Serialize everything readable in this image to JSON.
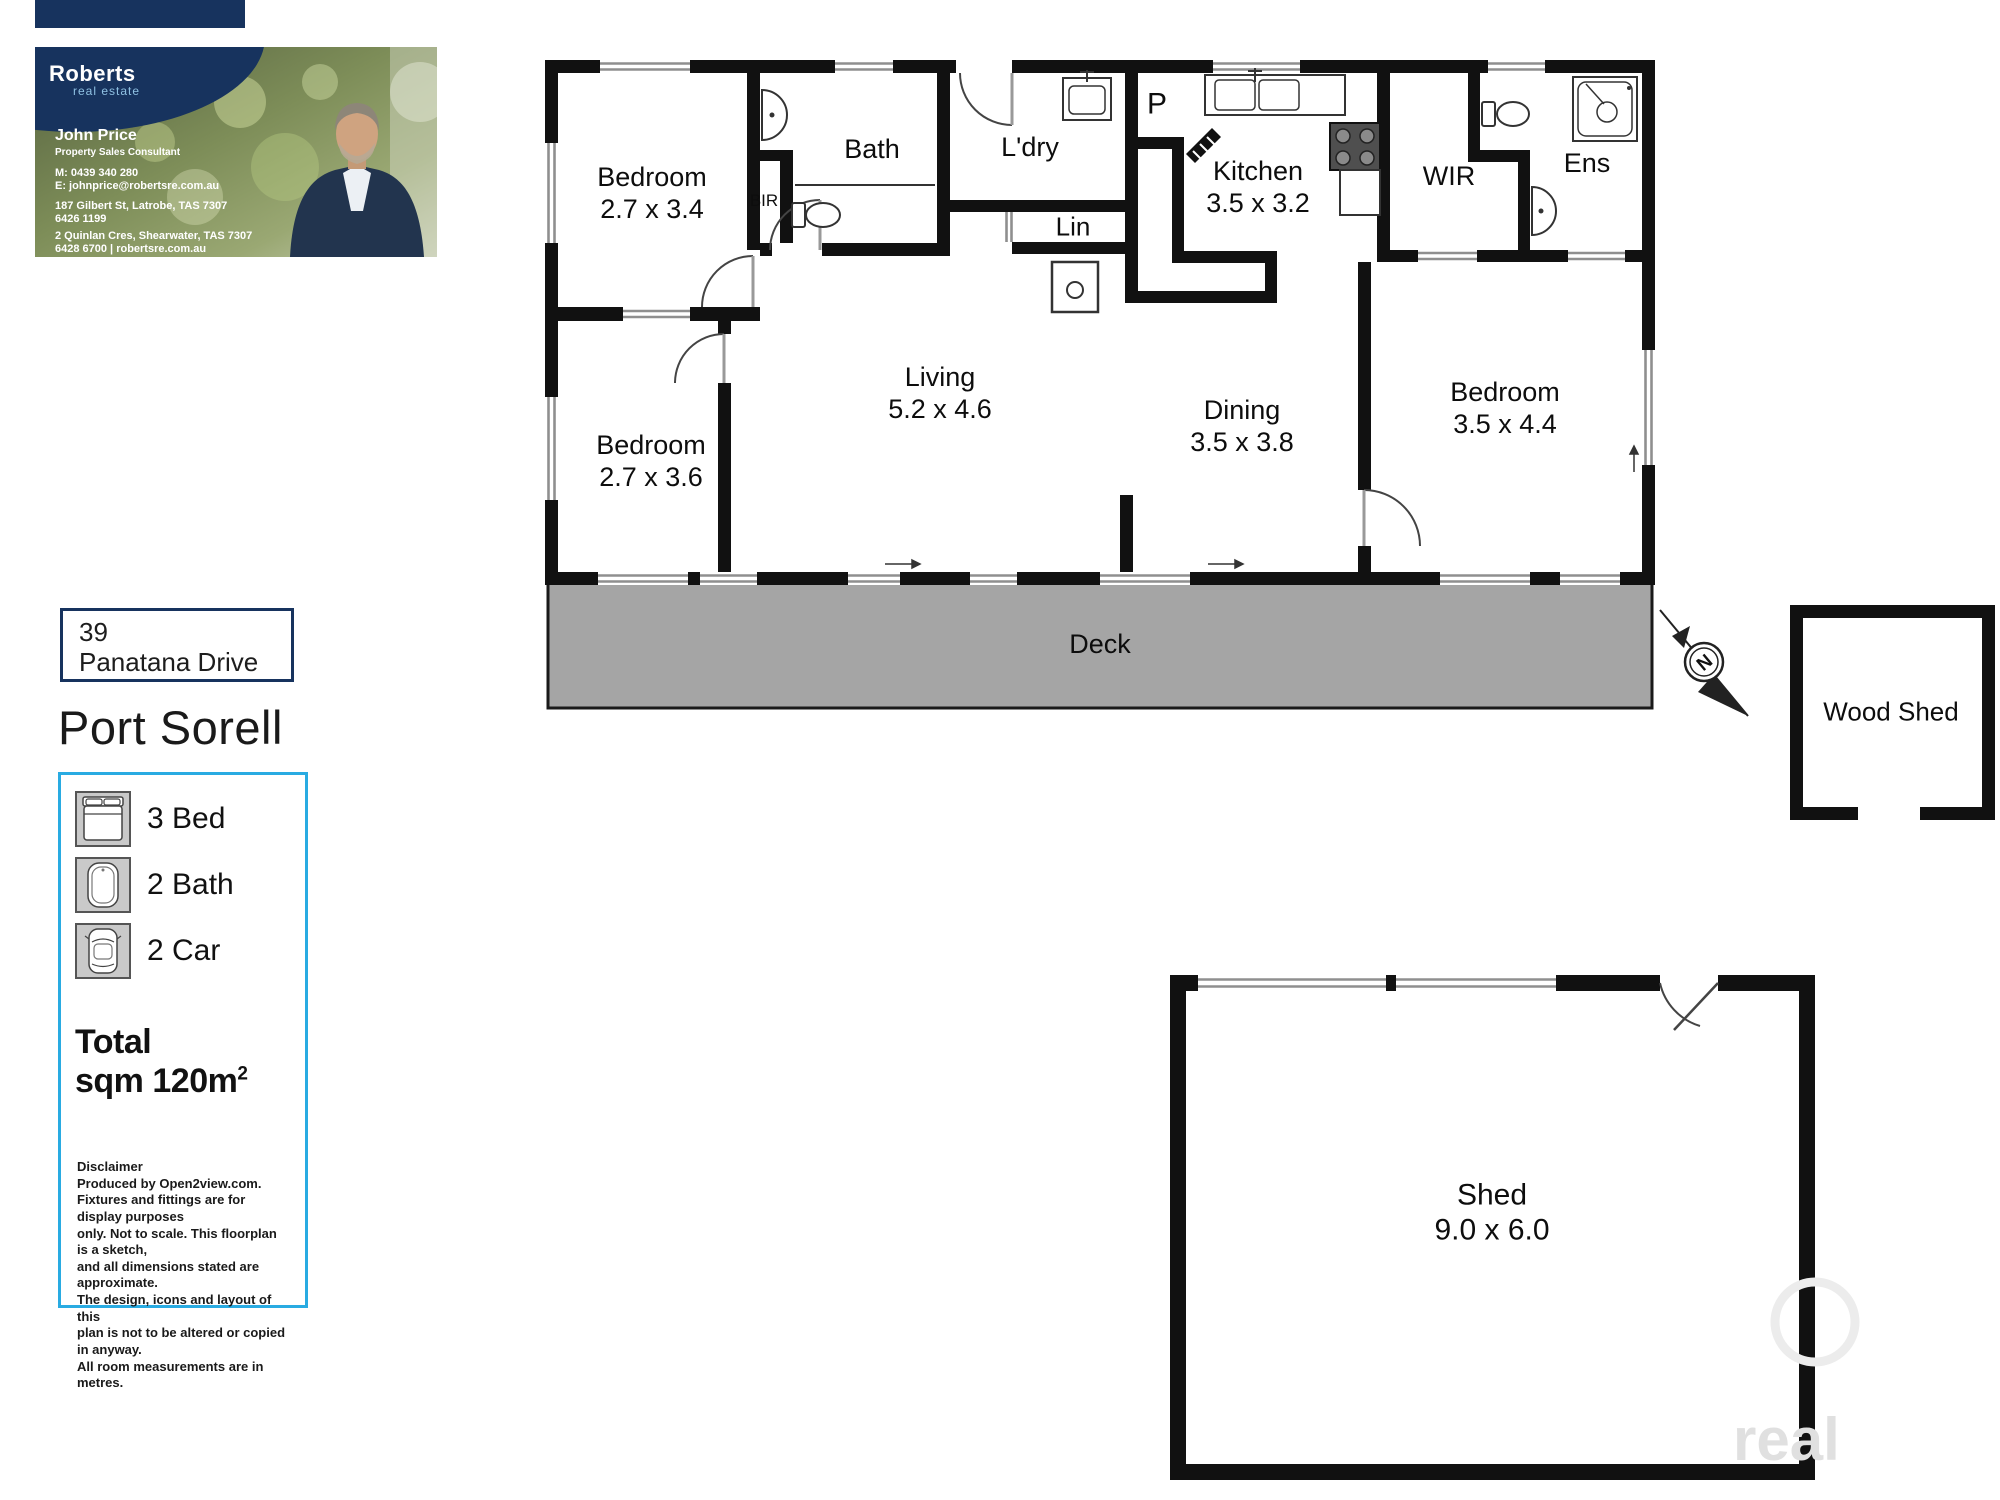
{
  "agent_card": {
    "brand": "Roberts",
    "brand_sub": "real estate",
    "name": "John Price",
    "title": "Property Sales Consultant",
    "mobile": "M: 0439 340 280",
    "email": "E: johnprice@robertsre.com.au",
    "office1_address": "187 Gilbert St, Latrobe, TAS 7307",
    "office1_phone": "6426 1199",
    "office2_address": "2 Quinlan Cres, Shearwater, TAS 7307",
    "office2_phone": "6428 6700  |  robertsre.com.au"
  },
  "address": {
    "street_number": "39",
    "street_name": "Panatana Drive",
    "suburb": "Port Sorell"
  },
  "features": [
    {
      "icon": "bed-icon",
      "label": "3 Bed"
    },
    {
      "icon": "bath-icon",
      "label": "2 Bath"
    },
    {
      "icon": "car-icon",
      "label": "2 Car"
    }
  ],
  "total": {
    "label": "Total sqm",
    "value": "120",
    "unit": "m",
    "sup": "2"
  },
  "disclaimer": {
    "heading": "Disclaimer",
    "lines": [
      "Produced by Open2view.com.",
      "Fixtures and fittings are for display purposes",
      "only. Not to scale. This floorplan is a sketch,",
      "and all dimensions stated are approximate.",
      "The design, icons and layout of this",
      "plan is not to be altered or copied",
      "in anyway.",
      "All room measurements are in",
      "metres."
    ]
  },
  "rooms": {
    "bed1": {
      "name": "Bedroom",
      "dims": "2.7 x 3.4"
    },
    "bath": {
      "name": "Bath"
    },
    "bir": {
      "name": "BIR"
    },
    "ldry": {
      "name": "L'dry"
    },
    "lin": {
      "name": "Lin"
    },
    "pantry": {
      "name": "P"
    },
    "kitchen": {
      "name": "Kitchen",
      "dims": "3.5 x 3.2"
    },
    "wir": {
      "name": "WIR"
    },
    "ens": {
      "name": "Ens"
    },
    "living": {
      "name": "Living",
      "dims": "5.2 x 4.6"
    },
    "dining": {
      "name": "Dining",
      "dims": "3.5 x 3.8"
    },
    "bed3": {
      "name": "Bedroom",
      "dims": "3.5 x 4.4"
    },
    "bed2": {
      "name": "Bedroom",
      "dims": "2.7 x 3.6"
    },
    "deck": {
      "name": "Deck"
    }
  },
  "outbuildings": {
    "woodshed": {
      "name": "Wood Shed"
    },
    "shed": {
      "name": "Shed",
      "dims": "9.0 x 6.0"
    }
  },
  "compass": {
    "letter": "N"
  },
  "watermark": {
    "text": "real"
  },
  "colors": {
    "navy": "#17335e",
    "accent_cyan": "#29abe2",
    "wall_black": "#111111",
    "deck_gray": "#a5a5a5",
    "window_gray": "#8f8f8f",
    "logo_blue": "#8fc1e3"
  }
}
